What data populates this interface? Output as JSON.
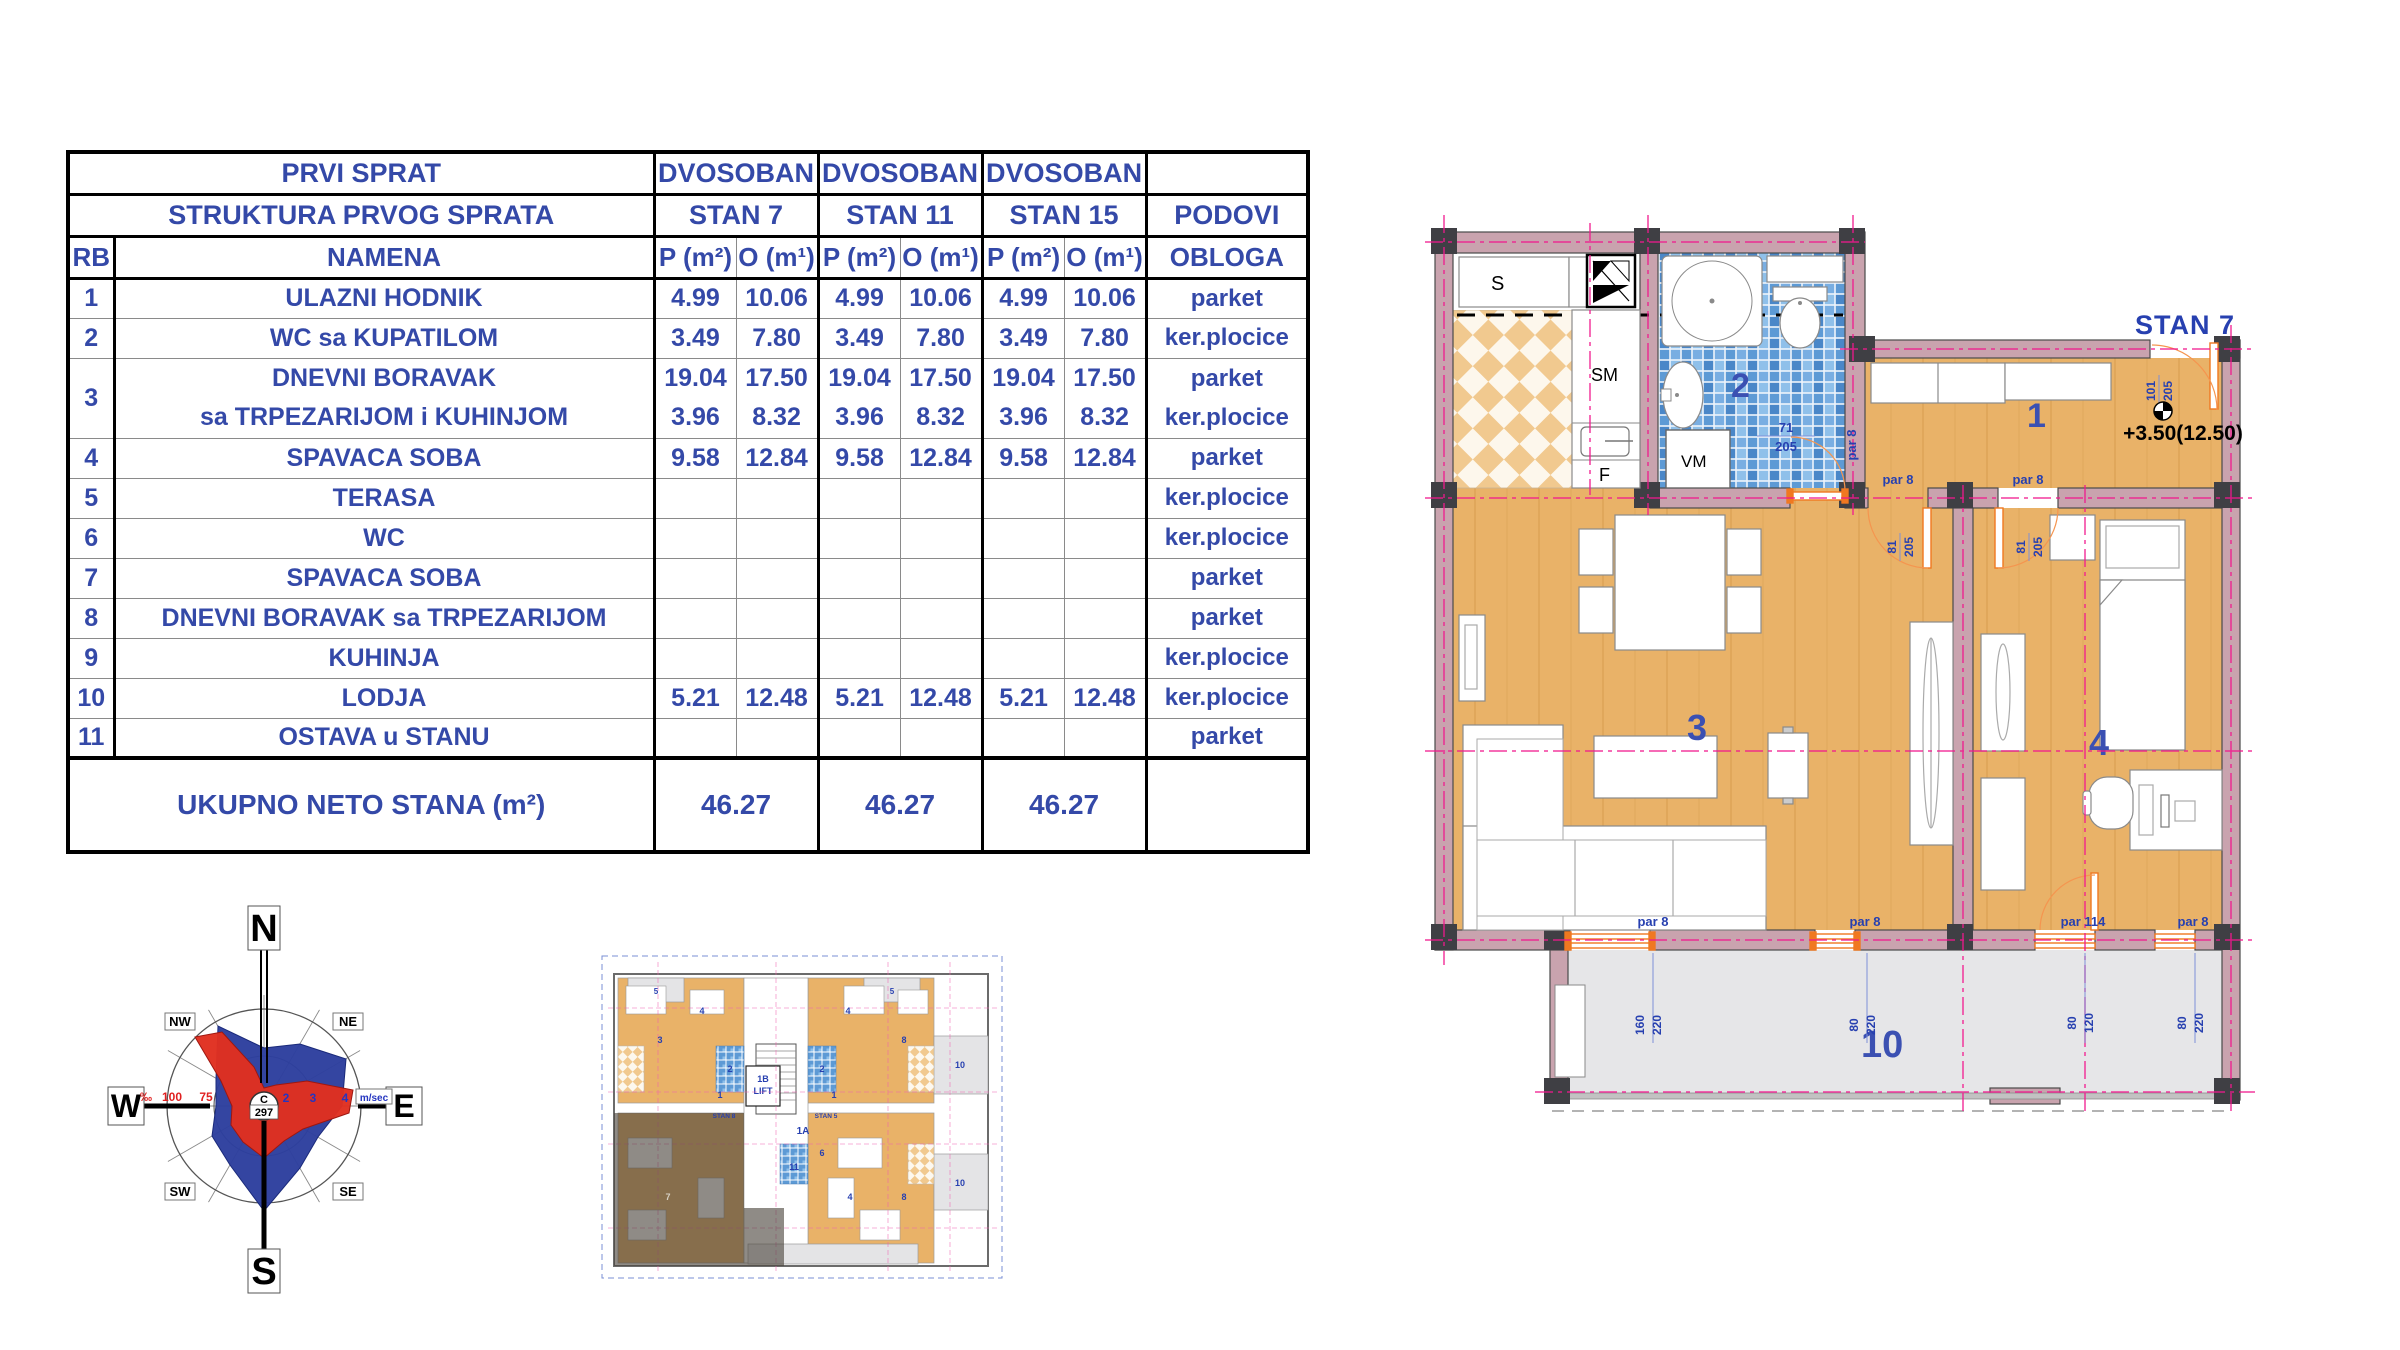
{
  "table": {
    "header": {
      "title": "PRVI SPRAT",
      "subtitle": "STRUKTURA PRVOG SPRATA",
      "types": [
        "DVOSOBAN",
        "DVOSOBAN",
        "DVOSOBAN"
      ],
      "stans": [
        "STAN 7",
        "STAN 11",
        "STAN 15"
      ],
      "podovi": "PODOVI",
      "rb": "RB",
      "namena": "NAMENA",
      "p": "P (m²)",
      "o": "O (m¹)",
      "obloga": "OBLOGA"
    },
    "rows": [
      {
        "rb": "1",
        "name": "ULAZNI HODNIK",
        "p7": "4.99",
        "o7": "10.06",
        "p11": "4.99",
        "o11": "10.06",
        "p15": "4.99",
        "o15": "10.06",
        "obloga": "parket"
      },
      {
        "rb": "2",
        "name": "WC sa KUPATILOM",
        "p7": "3.49",
        "o7": "7.80",
        "p11": "3.49",
        "o11": "7.80",
        "p15": "3.49",
        "o15": "7.80",
        "obloga": "ker.plocice"
      },
      {
        "rb": "3",
        "name": "DNEVNI BORAVAK",
        "name2": "sa TRPEZARIJOM i KUHINJOM",
        "p7": "19.04",
        "o7": "17.50",
        "p7b": "3.96",
        "o7b": "8.32",
        "p11": "19.04",
        "o11": "17.50",
        "p11b": "3.96",
        "o11b": "8.32",
        "p15": "19.04",
        "o15": "17.50",
        "p15b": "3.96",
        "o15b": "8.32",
        "obloga": "parket",
        "obloga2": "ker.plocice"
      },
      {
        "rb": "4",
        "name": "SPAVACA SOBA",
        "p7": "9.58",
        "o7": "12.84",
        "p11": "9.58",
        "o11": "12.84",
        "p15": "9.58",
        "o15": "12.84",
        "obloga": "parket"
      },
      {
        "rb": "5",
        "name": "TERASA",
        "obloga": "ker.plocice"
      },
      {
        "rb": "6",
        "name": "WC",
        "obloga": "ker.plocice"
      },
      {
        "rb": "7",
        "name": "SPAVACA SOBA",
        "obloga": "parket"
      },
      {
        "rb": "8",
        "name": "DNEVNI BORAVAK sa TRPEZARIJOM",
        "obloga": "parket"
      },
      {
        "rb": "9",
        "name": "KUHINJA",
        "obloga": "ker.plocice"
      },
      {
        "rb": "10",
        "name": "LODJA",
        "p7": "5.21",
        "o7": "12.48",
        "p11": "5.21",
        "o11": "12.48",
        "p15": "5.21",
        "o15": "12.48",
        "obloga": "ker.plocice"
      },
      {
        "rb": "11",
        "name": "OSTAVA u STANU",
        "obloga": "parket"
      }
    ],
    "total": {
      "label": "UKUPNO NETO STANA (m²)",
      "values": [
        "46.27",
        "46.27",
        "46.27"
      ]
    }
  },
  "windrose": {
    "n": "N",
    "s": "S",
    "e": "E",
    "w": "W",
    "ne": "NE",
    "nw": "NW",
    "se": "SE",
    "sw": "SW",
    "center_top": "C",
    "center_bottom": "297",
    "permille": "‰",
    "r100": "100",
    "r75": "75",
    "t2": "2",
    "t3": "3",
    "t4": "4",
    "unit": "m/sec",
    "colors": {
      "rose_blue": "#2d3f9e",
      "rose_red": "#e03020"
    }
  },
  "miniplan": {
    "lift": "LIFT",
    "oneB": "1B",
    "oneA": "1A",
    "stan8": "STAN 8",
    "stan5": "STAN 5",
    "digits": {
      "n1": "1",
      "n2": "2",
      "n3": "3",
      "n4": "4",
      "n5": "5",
      "n6": "6",
      "n7": "7",
      "n8": "8",
      "n9": "9",
      "n10": "10",
      "n11": "11"
    }
  },
  "plan": {
    "stan": "STAN 7",
    "level": "+3.50(12.50)",
    "rooms": {
      "r1": "1",
      "r2": "2",
      "r3": "3",
      "r4": "4",
      "r10": "10"
    },
    "labels": {
      "s": "S",
      "sm": "SM",
      "f": "F",
      "vm": "VM"
    },
    "dims": {
      "d71": "71",
      "d205": "205",
      "d101": "101",
      "d81": "81",
      "par8": "par 8",
      "par114": "par 114",
      "d160": "160",
      "d220": "220",
      "d80": "80",
      "d120": "120"
    },
    "colors": {
      "wall": "#c9a3ae",
      "column": "#3f3f44",
      "wood": "#e9b268",
      "loggia": "#e6e6e8",
      "mosaic": "#5d9ad5",
      "accent_orange": "#f07820",
      "centerline": "#f2188e",
      "dim_blue": "#2740b0"
    }
  }
}
